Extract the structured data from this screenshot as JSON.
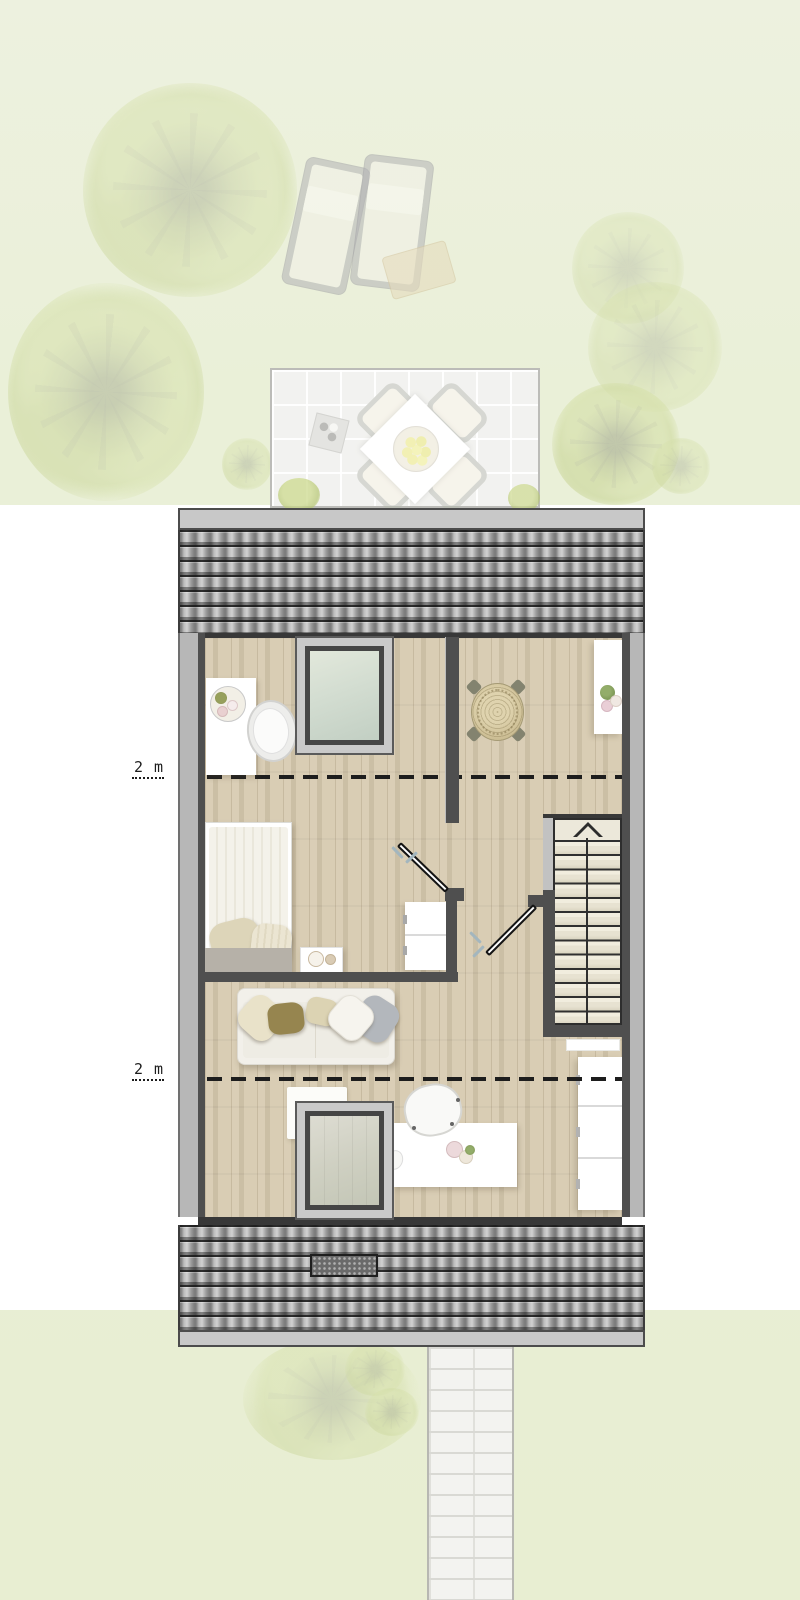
{
  "plan": {
    "height_lines": [
      {
        "label": "2 m"
      },
      {
        "label": "2 m"
      }
    ],
    "stairs": {
      "direction_icon": "up-arrow"
    },
    "palette": {
      "garden_green": "#eaf0d8",
      "white_band": "#ffffff",
      "roof_tile_gray": "#a8a8a8",
      "floor_wood": "#d6c9ae",
      "wall_dark": "#4f4f4f",
      "stair_tread": "#ebe7d8"
    }
  }
}
